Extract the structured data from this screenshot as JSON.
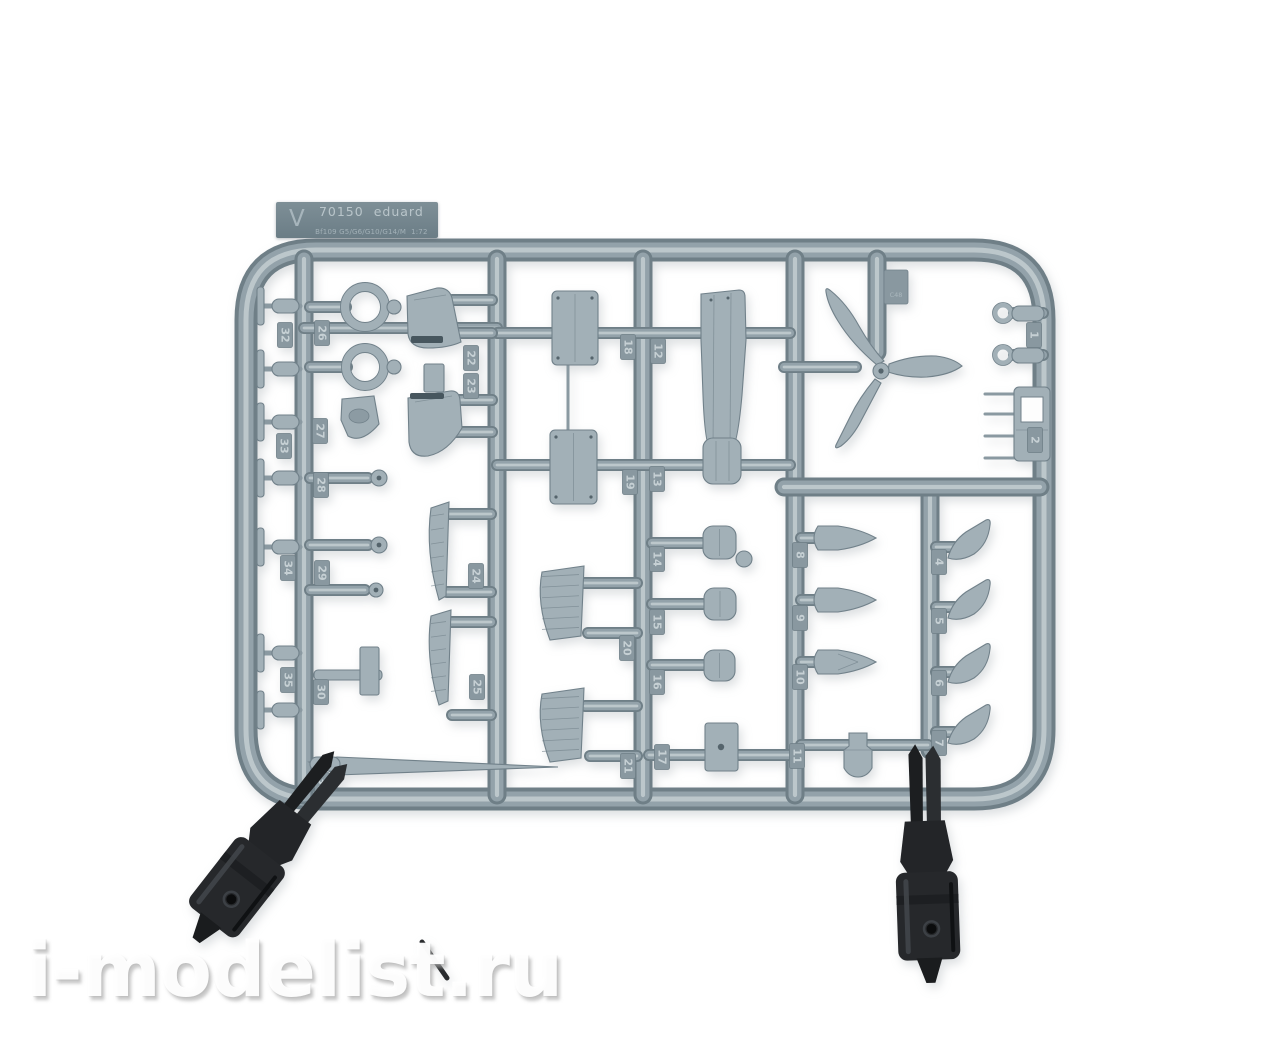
{
  "photo": {
    "background_color": "#ffffff"
  },
  "label": {
    "sprue_letter": "V",
    "kit_number": "70150",
    "brand": "eduard",
    "variant": "Bf109 G5/G6/G10/G14/M",
    "scale": "1:72",
    "bg_color": "#76878f",
    "text_color": "#b7c3c8"
  },
  "sprue": {
    "plastic_color": "#a2b0b7",
    "rail_color": "#93a2aa",
    "tag_color": "#8998a0",
    "tag_text_color": "#c6d0d4",
    "mold_tab_text": "C48",
    "part_tags": [
      {
        "n": "32",
        "x": 285,
        "y": 335
      },
      {
        "n": "26",
        "x": 322,
        "y": 333
      },
      {
        "n": "27",
        "x": 320,
        "y": 431
      },
      {
        "n": "33",
        "x": 284,
        "y": 446
      },
      {
        "n": "28",
        "x": 321,
        "y": 485
      },
      {
        "n": "34",
        "x": 288,
        "y": 568
      },
      {
        "n": "29",
        "x": 322,
        "y": 573
      },
      {
        "n": "35",
        "x": 288,
        "y": 680
      },
      {
        "n": "30",
        "x": 321,
        "y": 692
      },
      {
        "n": "31",
        "x": 322,
        "y": 785
      },
      {
        "n": "22",
        "x": 471,
        "y": 358
      },
      {
        "n": "23",
        "x": 471,
        "y": 386
      },
      {
        "n": "24",
        "x": 476,
        "y": 576
      },
      {
        "n": "25",
        "x": 477,
        "y": 687
      },
      {
        "n": "18",
        "x": 628,
        "y": 347
      },
      {
        "n": "12",
        "x": 658,
        "y": 351
      },
      {
        "n": "19",
        "x": 630,
        "y": 482
      },
      {
        "n": "13",
        "x": 657,
        "y": 479
      },
      {
        "n": "14",
        "x": 657,
        "y": 559
      },
      {
        "n": "15",
        "x": 657,
        "y": 622
      },
      {
        "n": "16",
        "x": 657,
        "y": 682
      },
      {
        "n": "20",
        "x": 627,
        "y": 648
      },
      {
        "n": "21",
        "x": 628,
        "y": 766
      },
      {
        "n": "17",
        "x": 662,
        "y": 757
      },
      {
        "n": "1",
        "x": 1034,
        "y": 335
      },
      {
        "n": "2",
        "x": 1035,
        "y": 440
      },
      {
        "n": "8",
        "x": 800,
        "y": 555
      },
      {
        "n": "9",
        "x": 800,
        "y": 618
      },
      {
        "n": "10",
        "x": 800,
        "y": 677
      },
      {
        "n": "11",
        "x": 797,
        "y": 756
      },
      {
        "n": "4",
        "x": 939,
        "y": 562
      },
      {
        "n": "5",
        "x": 939,
        "y": 621
      },
      {
        "n": "6",
        "x": 939,
        "y": 683
      },
      {
        "n": "7",
        "x": 939,
        "y": 743
      }
    ]
  },
  "clips": {
    "color": "#26282b"
  },
  "watermark": {
    "text": "i-modelist.ru"
  }
}
